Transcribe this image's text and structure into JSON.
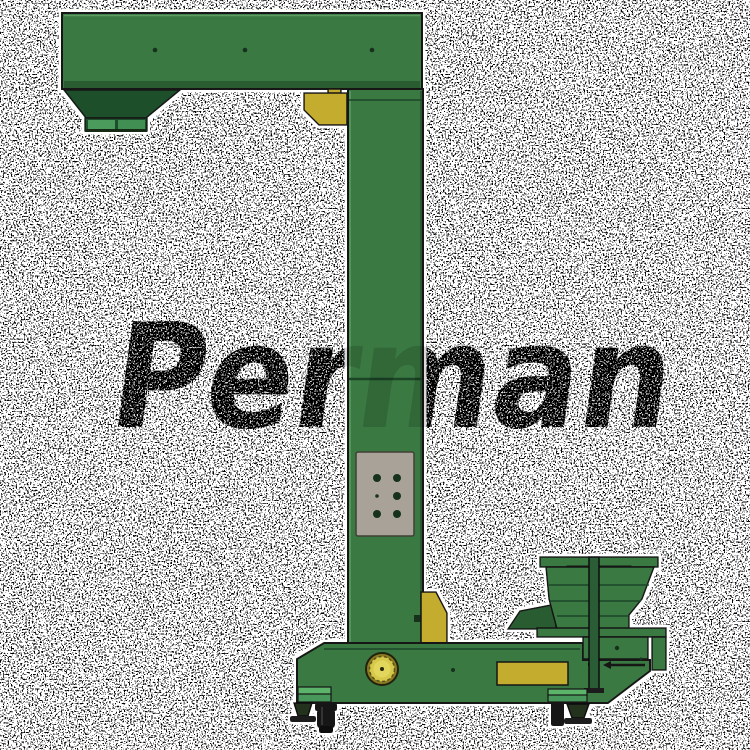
{
  "title": "Z-type bucket elevator product image",
  "background": {
    "color": "#ffffff",
    "noise": "salt-and-pepper speckle"
  },
  "watermark": {
    "text": "Perman",
    "color": "#000000",
    "overlay_opacity": "0.14"
  },
  "machine": {
    "type": "z-type vertical elevator conveyor with vibratory infeed hopper",
    "colors": {
      "body_green": "#3b7943",
      "dark_green": "#1d4f2b",
      "accent_yellow": "#c4ad2f",
      "motor_yellow": "#ddd04a",
      "bracket_light_green": "#5cb36b",
      "panel_gray": "#a8a298",
      "outline": "#141414"
    },
    "parts": [
      "top-discharge-arm",
      "discharge-hopper",
      "elevator-column",
      "control-panel",
      "yellow-guard-blocks",
      "drive-motor",
      "machine-base",
      "infeed-hopper",
      "hopper-support-bar",
      "leveling-feet",
      "caster-wheels"
    ]
  }
}
